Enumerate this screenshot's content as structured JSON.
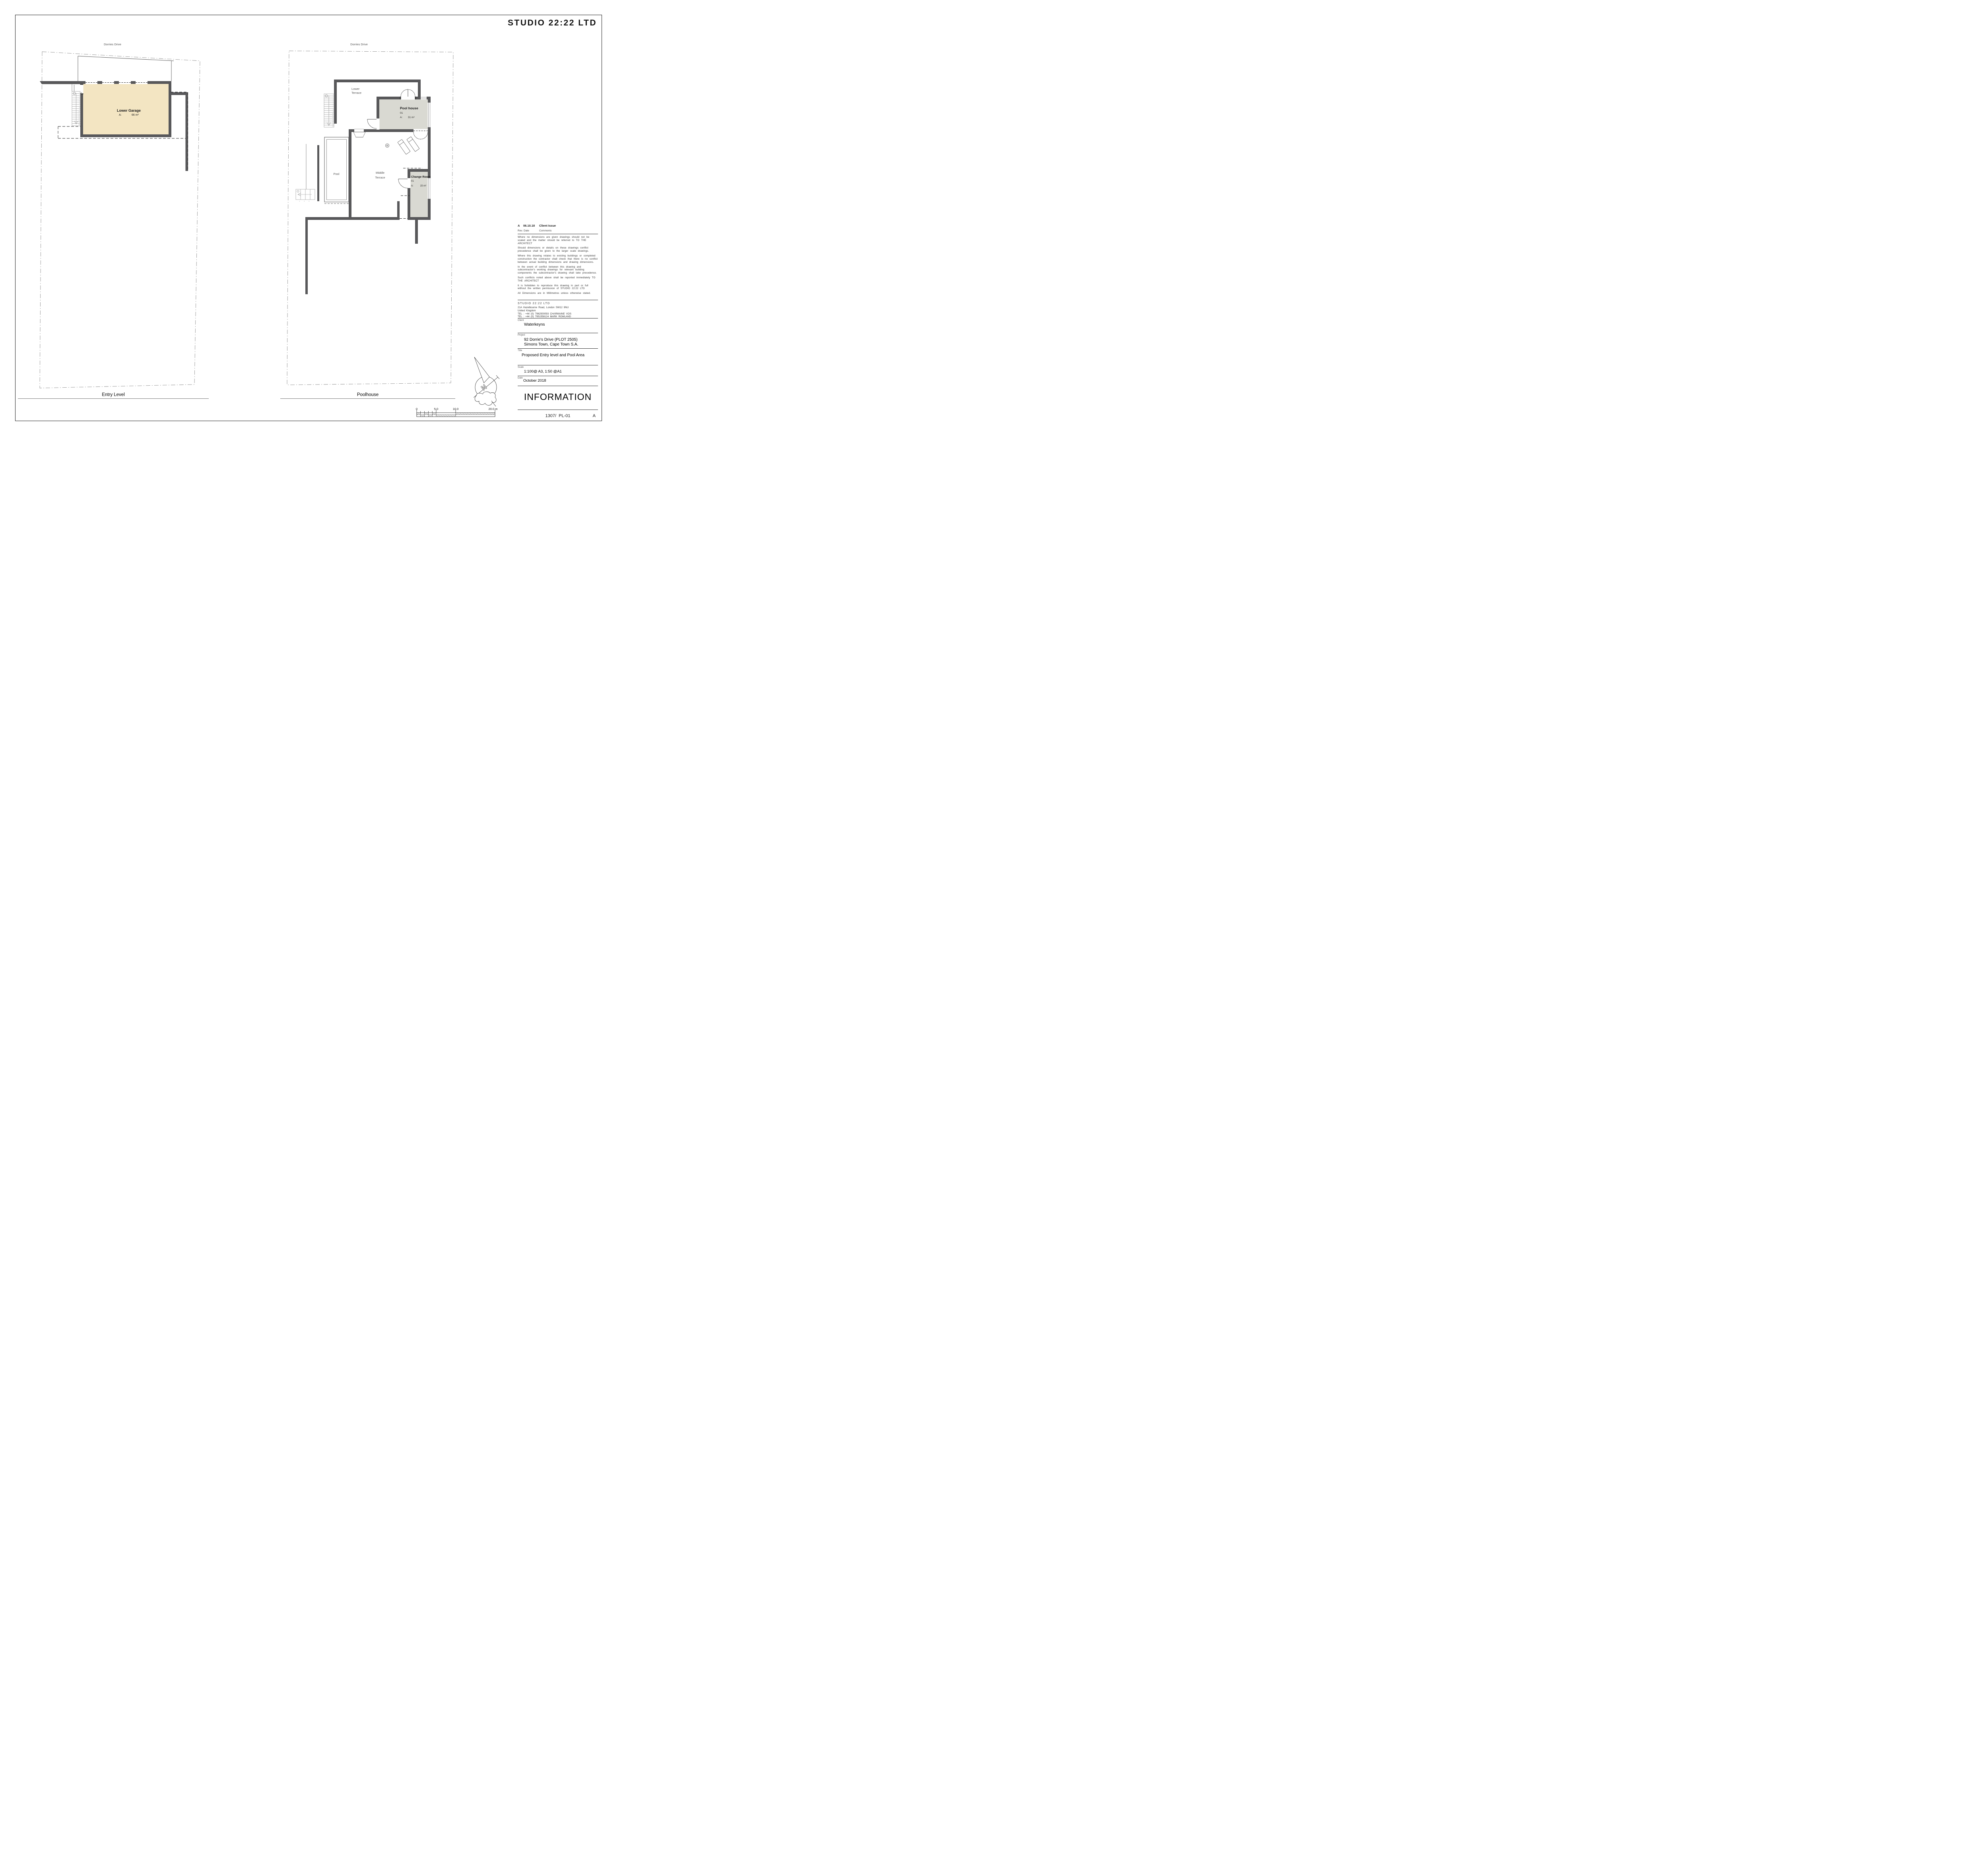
{
  "logo": "STUDIO 22:22 LTD",
  "plans": {
    "entry": {
      "street": "Dorries Drive",
      "title": "Entry Level",
      "garage": {
        "name": "Lower Garage",
        "area_label": "A:",
        "area_value": "66 m²"
      }
    },
    "pool": {
      "street": "Dorries Drive",
      "title": "Poolhouse",
      "lower_terrace": [
        "Lower",
        "Terrace"
      ],
      "middle_terrace": [
        "Middle",
        "Terrace"
      ],
      "pool_label": "Pool",
      "pool_house": {
        "name": "Pool house",
        "number": "01",
        "area_label": "A:",
        "area_value": "31 m²"
      },
      "change_room": {
        "name": "Change Room",
        "number": "01",
        "area_label": "A:",
        "area_value": "15 m²"
      }
    }
  },
  "stairs": {
    "entry_tread_count": 16,
    "terrace_tread_count": 16,
    "lower_tread_count": 3
  },
  "compass": {
    "letter": "N"
  },
  "scalebar": {
    "t0": "0",
    "t5": "5.0",
    "t10": "10.0",
    "t20": "20.0 m"
  },
  "titleblock": {
    "revision": {
      "rev": "A",
      "date": "06.10.18",
      "comment": "Client Issue"
    },
    "rev_header": {
      "rev": "Rev.",
      "date": "Date",
      "comments": "Comments"
    },
    "notes": [
      "Where no dimensions are given drawings should not be scaled and the matter should be referred to TO THE ARCHITECT",
      "Should dimensions or details on these drawings conflict precedence shall be given to the larger scale drawings.",
      "Where this drawing relates to existing buildings or completed construction the contractor shall check that there is no conflict between actual building dimensions and drawing dimensions.",
      "In the event of conflict between this drawing and subcontractor's working drawings for relevant building components the subcontractor's drawing shall take precedence.",
      "Such conflicts noted above shall be reported immediately TO THE ARCHITECT",
      "It is forbidden to reproduce this drawing in part or full without the written permission of STUDIO 22:22 LTD",
      "All Dimensions are in Millimetres unless otherwise stated."
    ],
    "studio": {
      "name": "STUDIO 22:22 LTD",
      "address1": "21A Hazelbourne Road, London SW12 9NU",
      "address2": "United Kingdom",
      "tel1": "TEL : +44 (0) 7962500093 CHARMAINE VOS",
      "tel2": "TEL : +44 (0) 7951558124 MARK ROWLAND"
    },
    "client": {
      "label": "Client",
      "value": "Waterkeyns"
    },
    "project": {
      "label": "Project",
      "line1": "92 Dorrie's Drive (PLOT 2505)",
      "line2": "Simons Town, Cape Town S.A."
    },
    "title": {
      "label": "Title",
      "value": "Proposed Entry level and Pool Area"
    },
    "scale": {
      "label": "Scale",
      "value": "1:100@ A3, 1:50 @A1"
    },
    "date": {
      "label": "Date",
      "value": "October 2018"
    },
    "status": "INFORMATION",
    "number": "1307/  PL-01",
    "rev_letter": "A"
  },
  "colors": {
    "wall": "#58585a",
    "garage_fill": "#f3e5c2",
    "room_fill": "#d9d9d2",
    "boundary": "#909090"
  }
}
